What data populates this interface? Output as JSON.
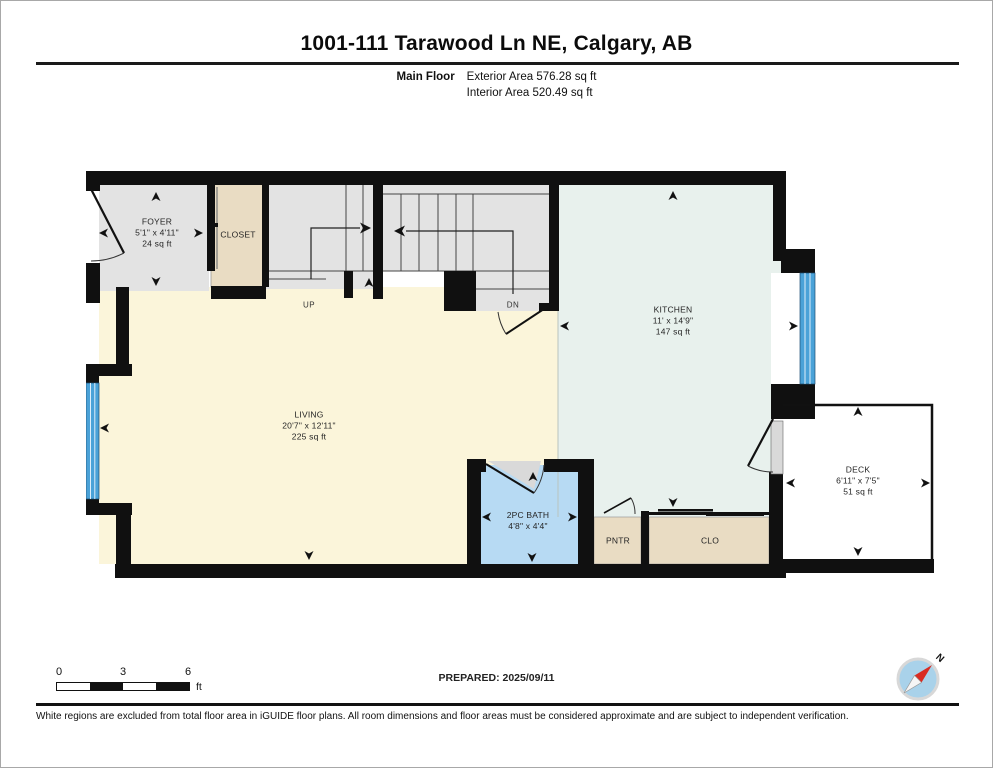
{
  "header": {
    "title": "1001-111 Tarawood Ln NE, Calgary, AB",
    "floor_label": "Main Floor",
    "exterior_area": "Exterior Area 576.28 sq ft",
    "interior_area": "Interior Area 520.49 sq ft"
  },
  "rooms": {
    "foyer": {
      "name": "FOYER",
      "dims": "5'1\" x 4'11\"",
      "area": "24 sq ft"
    },
    "closet": {
      "name": "CLOSET"
    },
    "living": {
      "name": "LIVING",
      "dims": "20'7\" x 12'11\"",
      "area": "225 sq ft"
    },
    "kitchen": {
      "name": "KITCHEN",
      "dims": "11' x 14'9\"",
      "area": "147 sq ft"
    },
    "bath": {
      "name": "2PC BATH",
      "dims": "4'8\" x 4'4\""
    },
    "pantry": {
      "name": "PNTR"
    },
    "clo": {
      "name": "CLO"
    },
    "deck": {
      "name": "DECK",
      "dims": "6'11\" x 7'5\"",
      "area": "51 sq ft"
    }
  },
  "stairs": {
    "up_label": "UP",
    "down_label": "DN"
  },
  "scale_bar": {
    "start": "0",
    "mid": "3",
    "end": "6",
    "unit": "ft"
  },
  "prepared_label": "PREPARED: 2025/09/11",
  "compass": {
    "north_label": "N"
  },
  "footer": {
    "disclaimer": "White regions are excluded from total floor area in iGUIDE floor plans. All room dimensions and floor areas must be considered approximate and are subject to independent verification."
  },
  "colors": {
    "wall": "#101010",
    "living_fill": "#fbf5da",
    "kitchen_fill": "#e8f1ed",
    "bath_fill": "#b7daf3",
    "closet_fill": "#e9dcc3",
    "stairs_fill": "#e3e3e3",
    "window_blue": "#4aa2d8",
    "compass_blue": "#a9d2ea",
    "compass_red": "#d92b21"
  }
}
